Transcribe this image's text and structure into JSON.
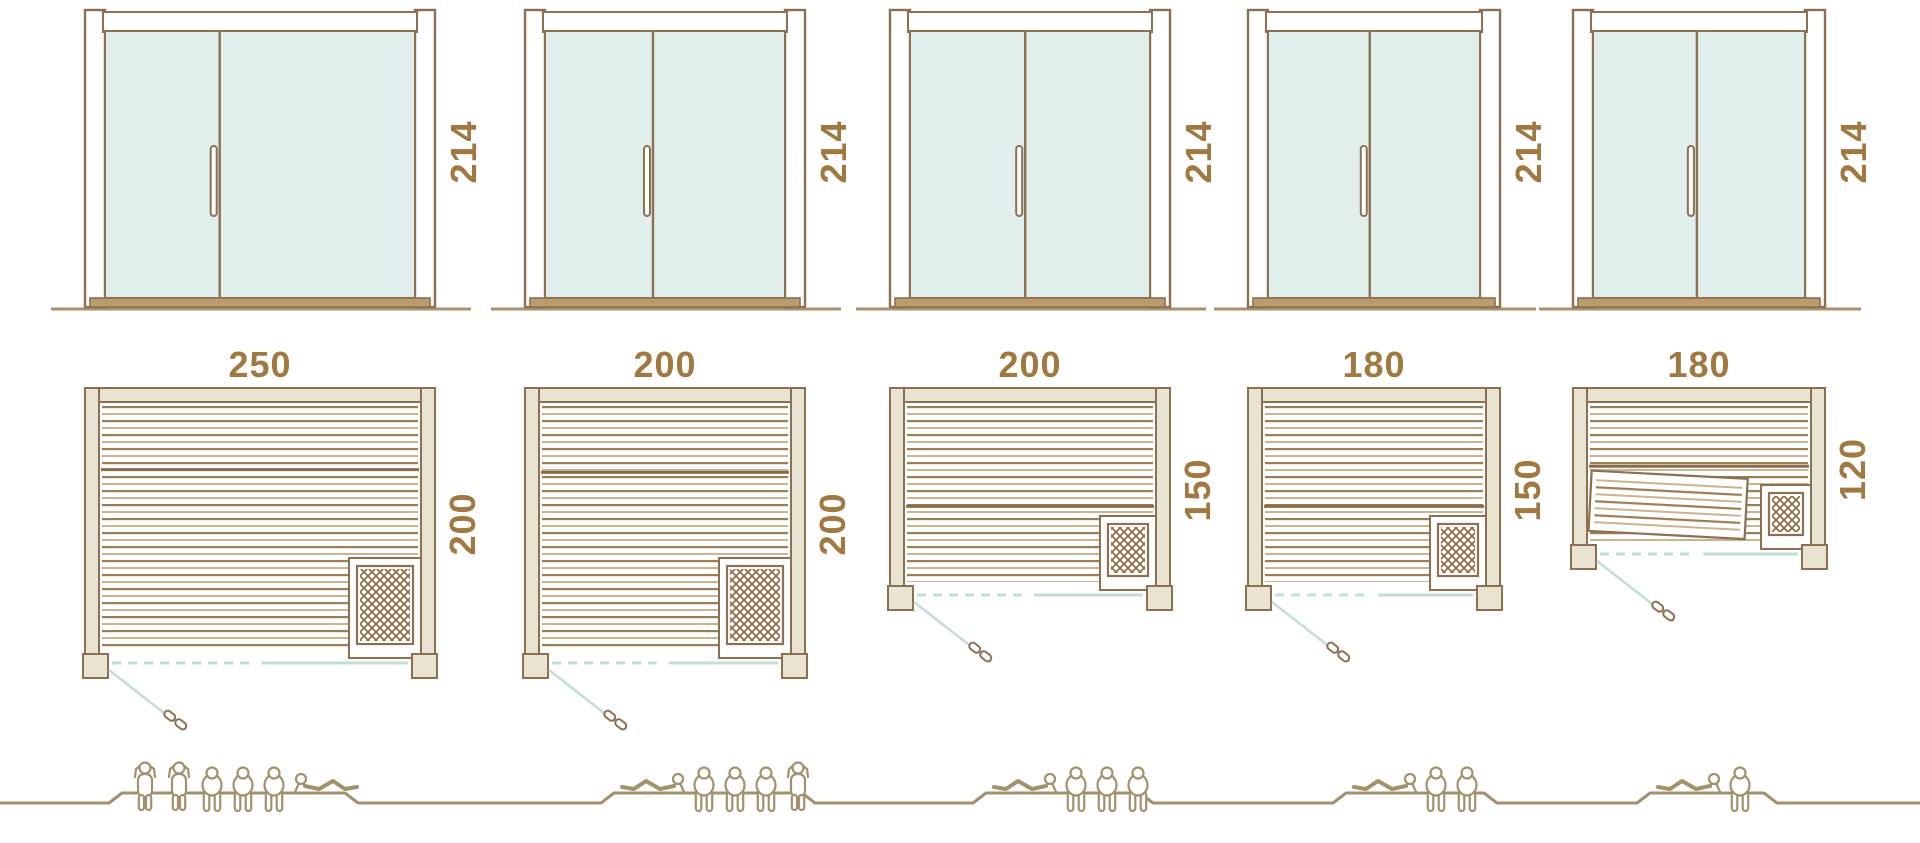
{
  "diagram": {
    "name": "Sauna cabin size comparison",
    "rows": [
      "door-elevations",
      "floor-plans",
      "capacity-figures"
    ],
    "units_count": 5
  },
  "colors": {
    "outline": "#8d7052",
    "wall_fill": "#e9e4d2",
    "glass_fill": "#e0efeb",
    "glass_line": "#c2ded8",
    "slat_dark": "#9b7d56",
    "slat_light": "#c9b48e",
    "bench_edge": "#8a6c48",
    "sill": "#bb9c6e",
    "ground": "#ab9169",
    "label": "#a1783f",
    "figure": "#a3906c",
    "lattice": "#8d6b43",
    "white": "#ffffff"
  },
  "units": [
    {
      "name": "sauna-250x200",
      "door": {
        "height_label": "214"
      },
      "plan": {
        "width_label": "250",
        "depth_label": "200",
        "width_cm": 250,
        "depth_cm": 200,
        "heater_position": "bottom-right",
        "door_position": "bottom-left",
        "tilted_bench": false
      },
      "capacity": {
        "figures": [
          "standing",
          "standing",
          "sitting",
          "sitting",
          "sitting",
          "reclining"
        ],
        "total_persons": 6
      }
    },
    {
      "name": "sauna-200x200",
      "door": {
        "height_label": "214"
      },
      "plan": {
        "width_label": "200",
        "depth_label": "200",
        "width_cm": 200,
        "depth_cm": 200,
        "heater_position": "bottom-right",
        "door_position": "bottom-left",
        "tilted_bench": false
      },
      "capacity": {
        "figures": [
          "reclining",
          "sitting",
          "sitting",
          "sitting",
          "standing"
        ],
        "total_persons": 5
      }
    },
    {
      "name": "sauna-200x150",
      "door": {
        "height_label": "214"
      },
      "plan": {
        "width_label": "200",
        "depth_label": "150",
        "width_cm": 200,
        "depth_cm": 150,
        "heater_position": "bottom-right",
        "door_position": "bottom-left",
        "tilted_bench": false
      },
      "capacity": {
        "figures": [
          "reclining",
          "sitting",
          "sitting",
          "sitting"
        ],
        "total_persons": 4
      }
    },
    {
      "name": "sauna-180x150",
      "door": {
        "height_label": "214"
      },
      "plan": {
        "width_label": "180",
        "depth_label": "150",
        "width_cm": 180,
        "depth_cm": 150,
        "heater_position": "bottom-right",
        "door_position": "bottom-left",
        "tilted_bench": false
      },
      "capacity": {
        "figures": [
          "reclining",
          "sitting",
          "sitting"
        ],
        "total_persons": 3
      }
    },
    {
      "name": "sauna-180x120",
      "door": {
        "height_label": "214"
      },
      "plan": {
        "width_label": "180",
        "depth_label": "120",
        "width_cm": 180,
        "depth_cm": 120,
        "heater_position": "bottom-right",
        "door_position": "bottom-left",
        "tilted_bench": true
      },
      "capacity": {
        "figures": [
          "reclining",
          "sitting"
        ],
        "total_persons": 2
      }
    }
  ]
}
